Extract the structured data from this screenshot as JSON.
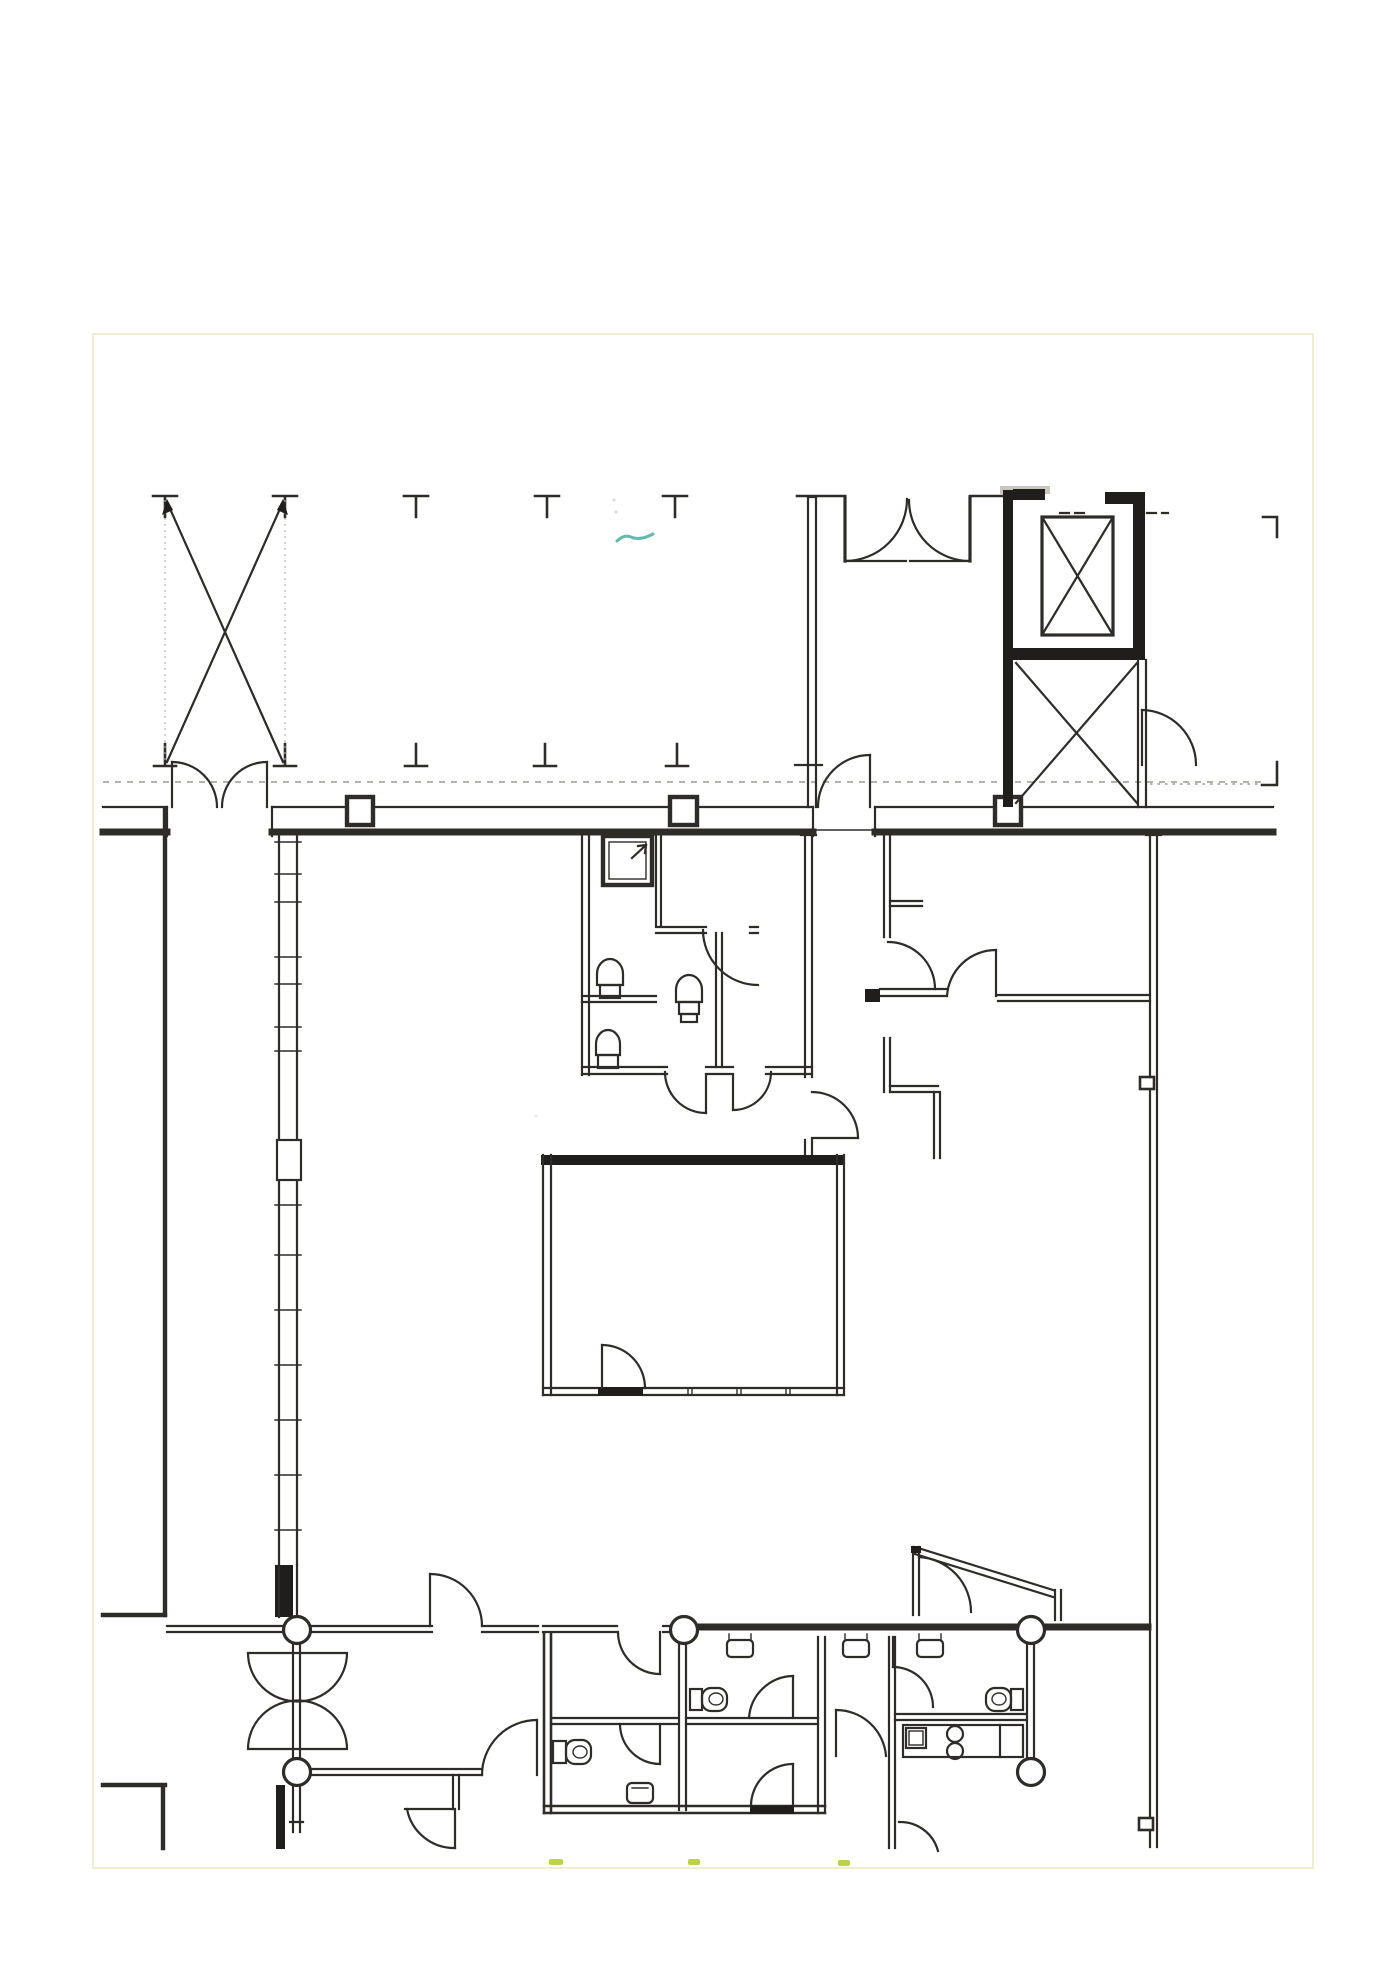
{
  "page": {
    "background": "#ffffff",
    "paper_edge_color": "#efedd2",
    "paper_rect": {
      "x": 92,
      "y": 333,
      "width": 1218,
      "height": 1532
    }
  },
  "colors": {
    "ink": "#2e2c29",
    "ink-heavy": "#1f1e1c",
    "guide": "#b5b2ac",
    "dash-line": "#9a988f",
    "hatch": "#c9c7bf",
    "teal-pen": "#63b9ae",
    "highlighter": "#bcd24e"
  },
  "drawing": {
    "kind": "scanned architectural floor plan, ink linework only, no text labels",
    "column_markers_top": {
      "glyph": "T",
      "count": 5,
      "y": 496,
      "x_positions": [
        165,
        285,
        416,
        547,
        675
      ]
    },
    "column_markers_bottom": {
      "glyph": "inverted-T",
      "count": 5,
      "y": 766,
      "x_positions": [
        165,
        285,
        416,
        545,
        677
      ]
    },
    "cross_brace": {
      "x1": 165,
      "x2": 285,
      "y_top": 497,
      "y_bottom": 764,
      "style": "X diagonals with arrowheads and dotted guides"
    },
    "wall_column_boxes": {
      "shape": "square",
      "count": 3,
      "centers_x": [
        360,
        683,
        1008
      ],
      "y_center": 811
    },
    "structural_circles": {
      "shape": "circle",
      "radius": 13.5,
      "count": 5,
      "centers": [
        [
          297,
          1630
        ],
        [
          684,
          1630
        ],
        [
          1031,
          1630
        ],
        [
          1031,
          1772
        ],
        [
          297,
          1772
        ]
      ]
    },
    "elevator_cab": {
      "rect": [
        1042,
        517,
        71,
        118
      ],
      "symbol": "box with X"
    },
    "secondary_shaft": {
      "rect": [
        1013,
        660,
        133,
        145
      ],
      "symbol": "tall X brace"
    },
    "shower_box": {
      "rect": [
        603,
        836,
        49,
        49
      ],
      "symbol": "nested squares with arrow"
    },
    "toilet_fixtures_upper_block": 3,
    "toilet_fixtures_lower_blocks": 3,
    "wash_basins": 3,
    "kitchen_counter": {
      "rect": [
        903,
        1725,
        120,
        32
      ],
      "burner_circles": 2,
      "stove_square": 1
    },
    "registration_corner_marks": [
      [
        1270,
        526
      ],
      [
        1270,
        774
      ]
    ]
  },
  "annotations": {
    "teal_pen_mark": {
      "x": 617,
      "y": 536,
      "width": 38
    },
    "highlighter_dashes": [
      [
        549,
        1861
      ],
      [
        688,
        1861
      ],
      [
        838,
        1862
      ]
    ]
  }
}
